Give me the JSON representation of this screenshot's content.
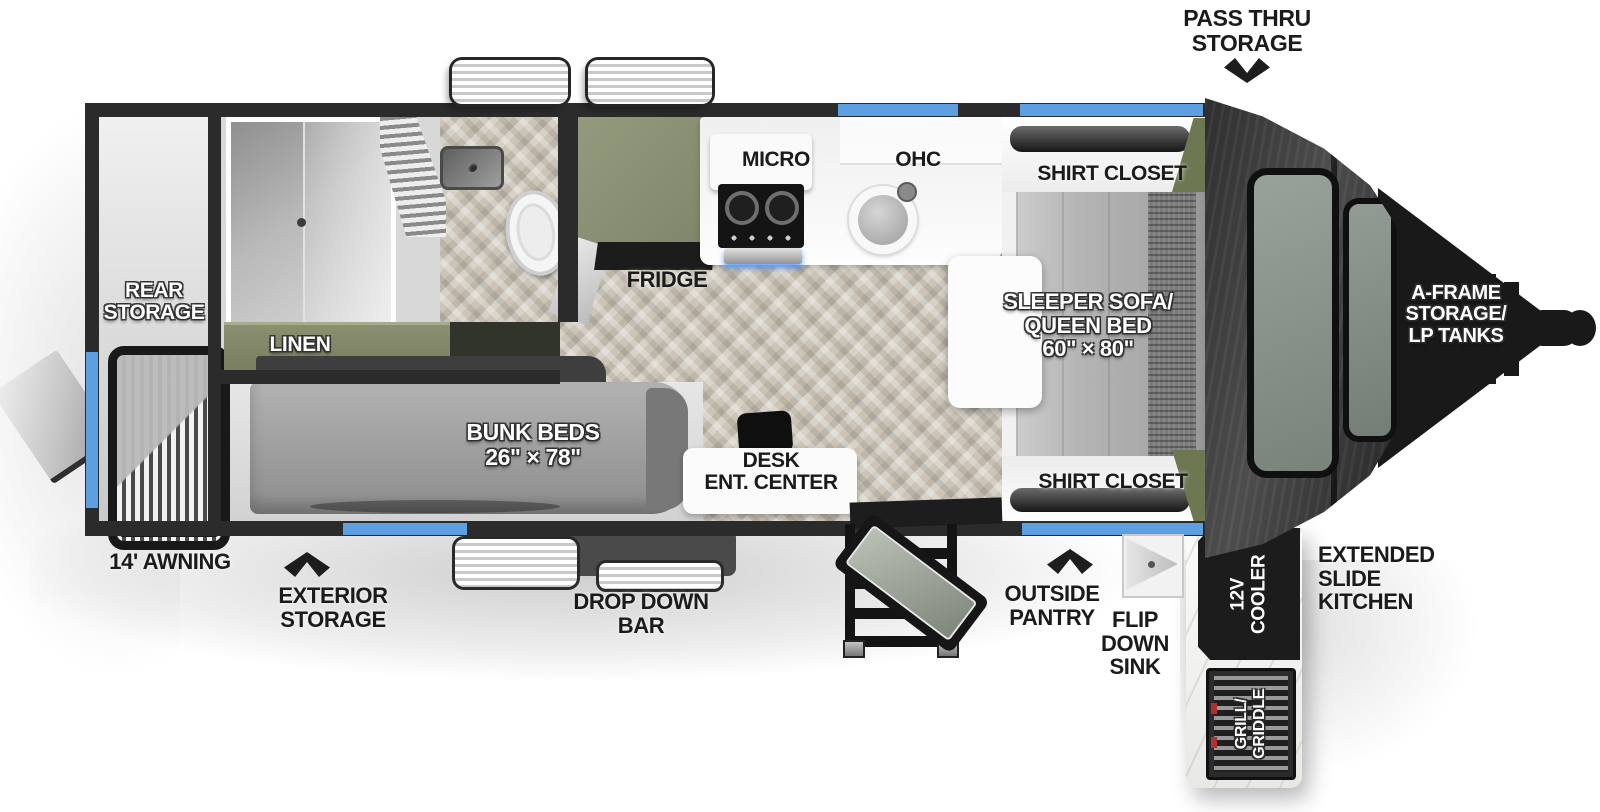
{
  "colors": {
    "accent_blue": "#5d9fe0",
    "wall_dark": "#2b2b2b",
    "cabinet_green": "#878d71",
    "wedge_green": "#6d7852",
    "floor_tile": "#ccc5b7"
  },
  "callouts": {
    "pass_thru_storage": "PASS THRU\nSTORAGE",
    "awning_length": "14' AWNING",
    "exterior_storage": "EXTERIOR\nSTORAGE",
    "drop_down_bar": "DROP DOWN\nBAR",
    "outside_pantry": "OUTSIDE\nPANTRY",
    "flip_down_sink": "FLIP\nDOWN\nSINK",
    "extended_slide_kitchen": "EXTENDED\nSLIDE\nKITCHEN",
    "a_frame_storage": "A-FRAME\nSTORAGE/\nLP TANKS"
  },
  "interior": {
    "rear_storage": "REAR\nSTORAGE",
    "linen": "LINEN",
    "bunk_beds": "BUNK BEDS\n26\" × 78\"",
    "desk_ent_center": "DESK\nENT. CENTER",
    "fridge": "FRIDGE",
    "micro": "MICRO",
    "ohc": "OHC",
    "shirt_closet_top": "SHIRT CLOSET",
    "shirt_closet_bottom": "SHIRT CLOSET",
    "sleeper_sofa": "SLEEPER SOFA/\nQUEEN BED\n60\" × 80\""
  },
  "exterior_kitchen": {
    "cooler_12v": "12V\nCOOLER",
    "grill_griddle": "GRILL/\nGRIDDLE"
  }
}
